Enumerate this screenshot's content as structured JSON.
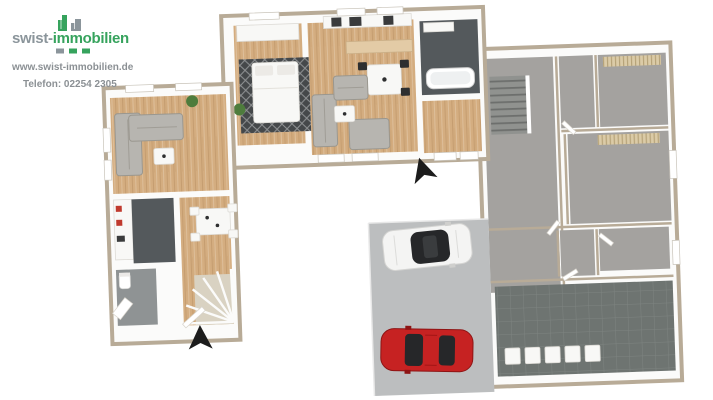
{
  "brand": {
    "name_part1": "swist-",
    "name_part2": "immobilien",
    "website": "www.swist-immobilien.de",
    "phone": "Telefon: 02254 2305"
  },
  "scene": {
    "type": "3d-floor-plan-rendering",
    "areas": [
      "furnished-apartment-left-wing",
      "furnished-apartment-top-wing",
      "unfurnished-apartment-right-wing",
      "hallway-with-winder-stairs",
      "utility-room",
      "garage-driveway",
      "courtyard"
    ],
    "vehicles": [
      {
        "name": "white-car",
        "color_key": "car_white"
      },
      {
        "name": "red-car",
        "color_key": "car_red"
      }
    ]
  },
  "colors": {
    "wall_cap": "#b8ab97",
    "wall_face": "#fbfbfa",
    "wood_floor": "#d4ad80",
    "dark_tile": "#54595c",
    "gray_floor": "#a4a29f",
    "wc_gray": "#8f9394",
    "utility_tile": "#6e7471",
    "utility_grid": "#7e8481",
    "driveway": "#bcbebf",
    "stairs_gray": "#90928f",
    "stairs_line": "#6d6f6d",
    "sofa": "#b7b5b0",
    "sofa_dark": "#9a978f",
    "furniture_white": "#f8f8f6",
    "rug_dark": "#45484a",
    "plant": "#4e7c3c",
    "radiator_beige": "#dbcba7",
    "radiator_line": "#b6a379",
    "car_red": "#c62222",
    "car_red_dark": "#8e1414",
    "car_white": "#f4f4f3",
    "glass_dark": "#262729",
    "arrow_black": "#1c1c1c",
    "logo_green": "#36a35d",
    "logo_gray": "#8b959b",
    "text_gray": "#8b9094"
  }
}
